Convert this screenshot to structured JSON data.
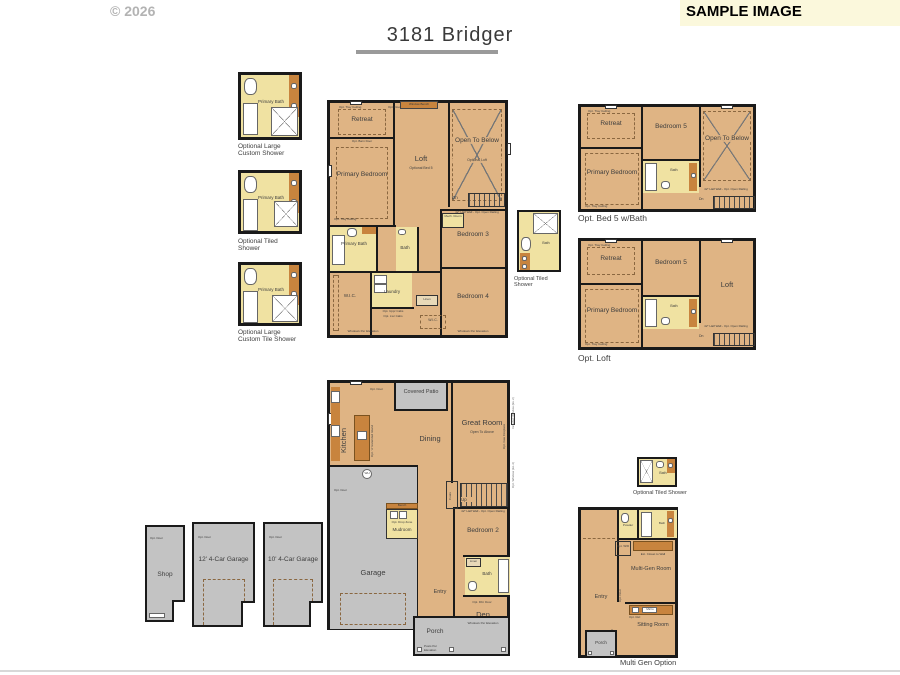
{
  "header": {
    "copyright": "© 2026",
    "title": "3181 Bridger",
    "banner": "SAMPLE IMAGE"
  },
  "bath_options": [
    {
      "room": "Primary Bath",
      "caption": "Optional Large Custom Shower"
    },
    {
      "room": "Primary Bath",
      "caption": "Optional Tiled Shower"
    },
    {
      "room": "Primary Bath",
      "caption": "Optional Large Custom Tile Shower"
    }
  ],
  "upper": {
    "window_bench": "Window Bench",
    "opt_door": "Opt. Door",
    "retreat": "Retreat",
    "tray_ceiling": "Opt. Tray Ceiling",
    "loft": "Loft",
    "loft_sub": "Optional Bed 5",
    "open_below": "Open To Below",
    "open_below_sub": "Optional Loft",
    "primary": "Primary Bedroom",
    "barn_door": "Opt. Barn Door",
    "primary_bath": "Primary Bath",
    "bath": "Bath",
    "laundry": "Laundry",
    "cab_note1": "Opt. Uppr Cabs",
    "cab_note2": "Opt. Lwr Cabs",
    "wic": "W.I.C.",
    "mech_room": "Mech. Room",
    "dn": "Dn",
    "half_wall": "42\" Half Wall - Opt. Open Railing",
    "bedroom3": "Bedroom 3",
    "bedroom4": "Bedroom 4",
    "linen": "Linen",
    "windows_note": "Windows Per Elevation"
  },
  "mid_shower": {
    "room": "Bath",
    "caption": "Optional Tiled Shower"
  },
  "opt_bed5": {
    "caption": "Opt. Bed 5 w/Bath",
    "retreat": "Retreat",
    "tray_ceiling": "Opt. Tray Ceiling",
    "bedroom5": "Bedroom 5",
    "open_below": "Open To Below",
    "primary": "Primary Bedroom",
    "bath": "Bath",
    "dn": "Dn",
    "half_wall": "42\" Half Wall - Opt. Open Railing"
  },
  "opt_loft": {
    "caption": "Opt. Loft",
    "retreat": "Retreat",
    "tray_ceiling": "Opt. Tray Ceiling",
    "bedroom5": "Bedroom 5",
    "loft": "Loft",
    "primary": "Primary Bedroom",
    "bath": "Bath",
    "dn": "Dn",
    "half_wall": "42\" Half Wall - Opt. Open Railing"
  },
  "main_floor": {
    "covered_patio": "Covered Patio",
    "opt_door": "Opt. Door",
    "kitchen": "Kitchen",
    "island_note": "Opt. 'A' Extended Island",
    "dining": "Dining",
    "great_room": "Great Room",
    "great_room_sub": "Open To Above",
    "fireplace_note": "Opt. Gas Fireplace",
    "window_note1": "Included Window (EL 2)",
    "window_note2": "Opt. Window (EL 2)",
    "pantry": "Pantry",
    "coats": "Coats",
    "up": "Up",
    "half_wall": "42\" Half Wall - Opt. Open Railing",
    "garage": "Garage",
    "wh": "WH",
    "mudroom": "Mudroom",
    "drop_zone": "Opt. Drop Zone",
    "bench": "Bench",
    "bedroom2": "Bedroom 2",
    "bath": "Bath",
    "linen": "Linen",
    "den": "Den",
    "dbl_door": "Opt. Dbl. Door",
    "entry": "Entry",
    "porch": "Porch",
    "windows_note": "Windows Per Elevation",
    "posts_note": "Posts Per Elevation"
  },
  "garage_options": [
    {
      "label": "Shop",
      "note": "Opt. Door"
    },
    {
      "label": "12' 4-Car Garage",
      "note": "Opt. Door"
    },
    {
      "label": "10' 4-Car Garage",
      "note": "Opt. Door"
    }
  ],
  "multigen": {
    "shower_caption": "Optional Tiled Shower",
    "shower_room": "Bath",
    "powder": "Powder",
    "bath": "Bath",
    "opt_wd": "Opt. W/D",
    "closet_note": "Ext. Closet to Wall",
    "room": "Multi-Gen Room",
    "opt_door": "Opt. Door",
    "entry": "Entry",
    "sitting_room": "Sitting Room",
    "micro": "Micro",
    "opt_ref": "Opt. Ref.",
    "opt_rail": "Opt. Rail",
    "porch": "Porch",
    "caption": "Multi Gen Option"
  },
  "colors": {
    "floor": "#dfb484",
    "bath": "#f0e2a2",
    "counter": "#c8843e",
    "gray": "#c3c3c3",
    "wall": "#1a1a1a",
    "banner_bg": "#fbf8dc"
  }
}
